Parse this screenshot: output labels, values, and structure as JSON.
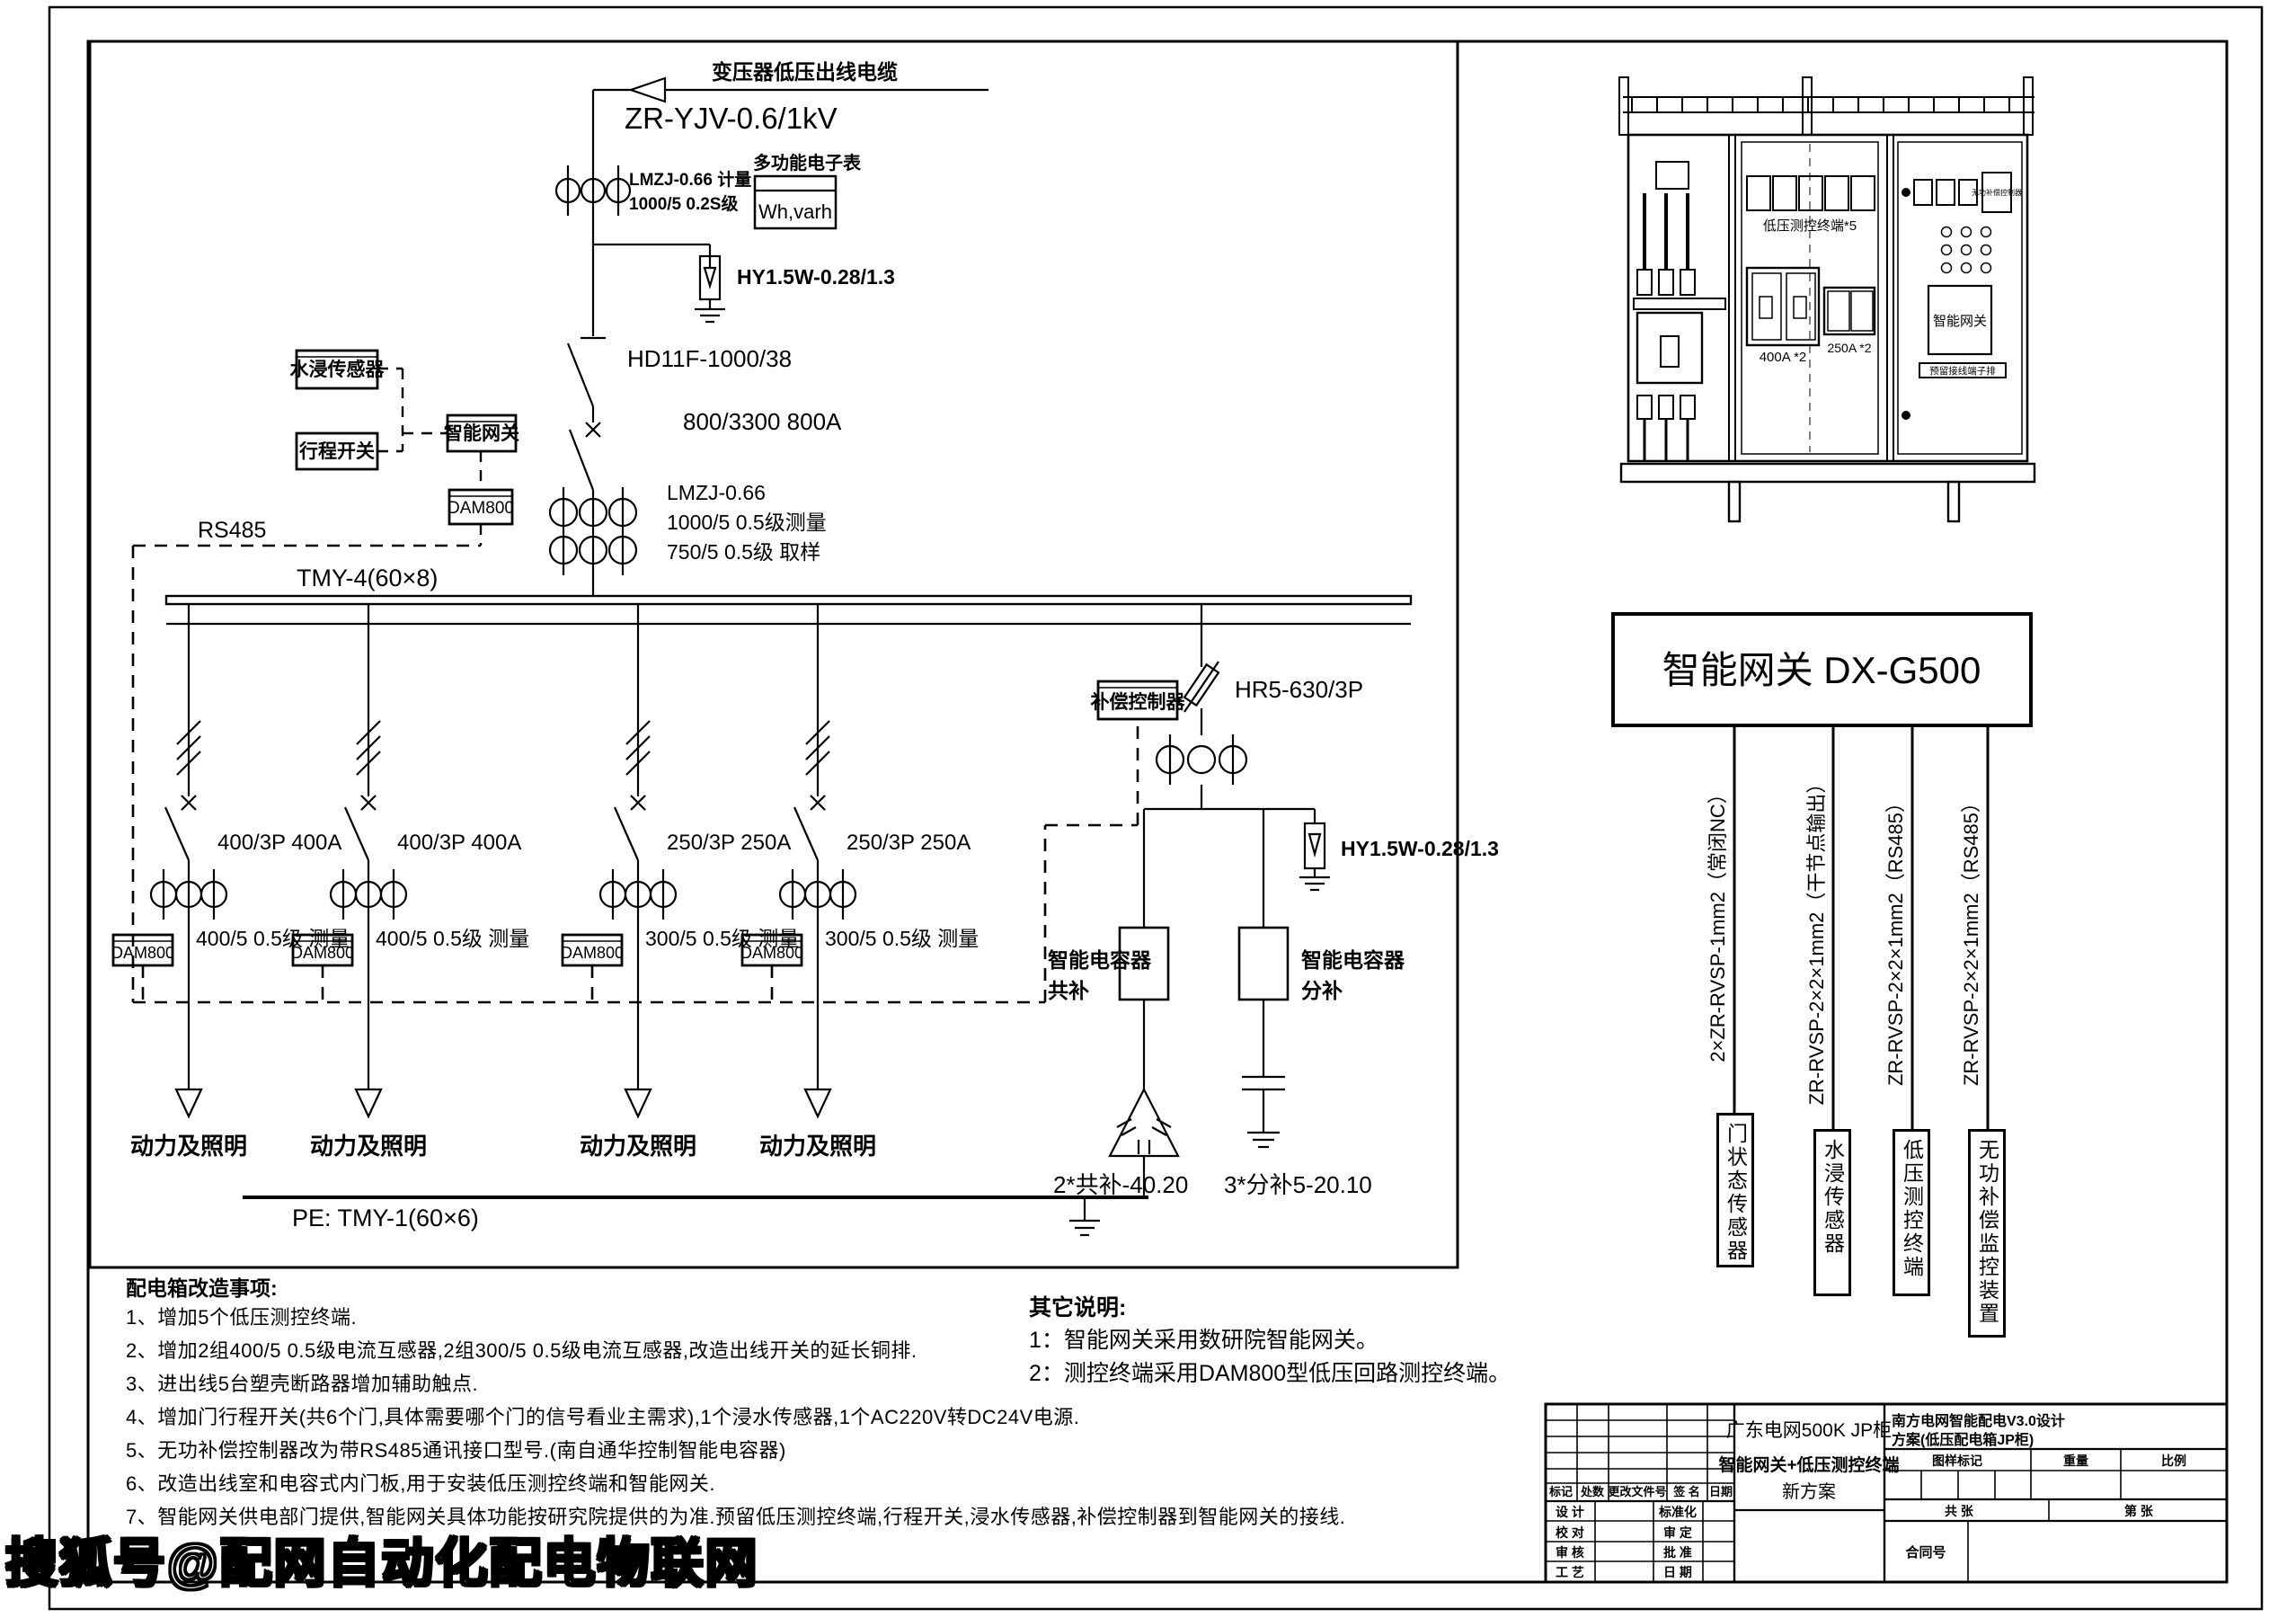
{
  "watermark": "搜狐号@配网自动化配电物联网",
  "incoming": {
    "cable_label": "变压器低压出线电缆",
    "cable_model": "ZR-YJV-0.6/1kV",
    "ct1_line1": "LMZJ-0.66 计量",
    "ct1_line2": "1000/5 0.2S级",
    "meter_title": "多功能电子表",
    "meter_text": "Wh,varh",
    "arrester": "HY1.5W-0.28/1.3",
    "disconnector": "HD11F-1000/38",
    "breaker": "800/3300 800A",
    "ct2_line1": "LMZJ-0.66",
    "ct2_line2": "1000/5 0.5级测量",
    "ct2_line3": "750/5 0.5级 取样"
  },
  "sensors": {
    "water": "水浸传感器",
    "travel": "行程开关",
    "gateway": "智能网关",
    "dam800": "DAM800",
    "rs485": "RS485"
  },
  "busbar": {
    "main": "TMY-4(60×8)",
    "pe": "PE: TMY-1(60×6)"
  },
  "feeders": [
    {
      "breaker": "400/3P  400A",
      "ct": "400/5 0.5级 测量",
      "terminal": "DAM800",
      "load": "动力及照明"
    },
    {
      "breaker": "400/3P 400A",
      "ct": "400/5 0.5级 测量",
      "terminal": "DAM800",
      "load": "动力及照明"
    },
    {
      "breaker": "250/3P  250A",
      "ct": "300/5 0.5级 测量",
      "terminal": "DAM800",
      "load": "动力及照明"
    },
    {
      "breaker": "250/3P 250A",
      "ct": "300/5 0.5级 测量",
      "terminal": "DAM800",
      "load": "动力及照明"
    }
  ],
  "compensation": {
    "controller": "补偿控制器",
    "fuse": "HR5-630/3P",
    "arrester": "HY1.5W-0.28/1.3",
    "cap_common_1": "智能电容器",
    "cap_common_2": "共补",
    "cap_split_1": "智能电容器",
    "cap_split_2": "分补",
    "common_value": "2*共补-40.20",
    "split_value": "3*分补5-20.10"
  },
  "notes": {
    "title": "配电箱改造事项:",
    "items": [
      "1、增加5个低压测控终端.",
      "2、增加2组400/5 0.5级电流互感器,2组300/5 0.5级电流互感器,改造出线开关的延长铜排.",
      "3、进出线5台塑壳断路器增加辅助触点.",
      "4、增加门行程开关(共6个门,具体需要哪个门的信号看业主需求),1个浸水传感器,1个AC220V转DC24V电源.",
      "5、无功补偿控制器改为带RS485通讯接口型号.(南自通华控制智能电容器)",
      "6、改造出线室和电容式内门板,用于安装低压测控终端和智能网关.",
      "7、智能网关供电部门提供,智能网关具体功能按研究院提供的为准.预留低压测控终端,行程开关,浸水传感器,补偿控制器到智能网关的接线."
    ]
  },
  "other_notes": {
    "title": "其它说明:",
    "items": [
      "1：智能网关采用数研院智能网关。",
      "2：测控终端采用DAM800型低压回路测控终端。"
    ]
  },
  "cabinet": {
    "lv_terminal": "低压测控终端*5",
    "breaker_400": "400A *2",
    "breaker_250": "250A *2",
    "gateway": "智能网关",
    "comp_controller": "无功补偿控制器",
    "terminal_strip": "预留接线端子排"
  },
  "gateway_panel": {
    "title": "智能网关 DX-G500",
    "cables": [
      "2×ZR-RVSP-1mm2（常闭NC）",
      "ZR-RVSP-2×2×1mm2（干节点输出）",
      "ZR-RVSP-2×2×1mm2（RS485）",
      "ZR-RVSP-2×2×1mm2（RS485）"
    ],
    "devices": [
      "门状态传感器",
      "水浸传感器",
      "低压测控终端",
      "无功补偿监控装置"
    ]
  },
  "title_block": {
    "product1": "广东电网500K JP柜",
    "product2": "智能网关+低压测控终端",
    "product3": "新方案",
    "project1": "南方电网智能配电V3.0设计",
    "project2": "方案(低压配电箱JP柜)",
    "col_mark": "标记",
    "col_count": "处数",
    "col_doc": "更改文件号",
    "col_sign": "签 名",
    "col_date": "日期",
    "row_design": "设 计",
    "row_std": "标准化",
    "row_check": "校 对",
    "row_review": "审 定",
    "row_audit": "审 核",
    "row_approve": "批 准",
    "row_craft": "工 艺",
    "row_date": "日 期",
    "mark_label": "图样标记",
    "weight_label": "重量",
    "scale_label": "比例",
    "sheets_total": "共  张",
    "sheet_no": "第  张",
    "contract": "合同号"
  }
}
